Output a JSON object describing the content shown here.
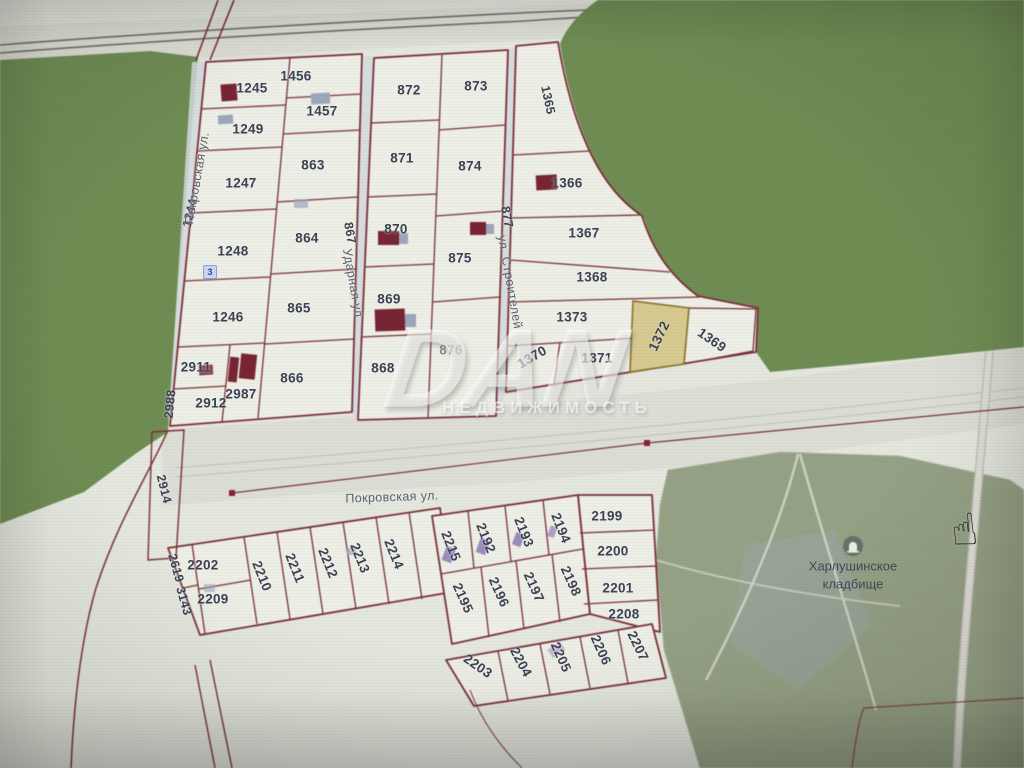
{
  "map": {
    "selected_parcel": "1372",
    "watermark": {
      "line1": "DAN",
      "line2": "НЕДВИЖИМОСТЬ"
    },
    "cemetery": {
      "line1": "Харлушинское",
      "line2": "кладбище"
    },
    "badge": {
      "text": "3"
    },
    "icons": {
      "cursor": "☝",
      "cemetery_icon": "grave-marker"
    },
    "colors": {
      "base": "#e4e7de",
      "roadFill": "#dcded6",
      "parcelFill": "#edefe6",
      "forest": "#6e8d50",
      "cemetery": "#95a184",
      "line": "#7d2f3a",
      "hlFill": "#d9c98e",
      "hlLine": "#8a7228",
      "label": "#3c4254",
      "street": "#59616e",
      "bldRed": "#7b2433",
      "bldGray": "#9ba7bb",
      "bldPurple": "#9c8cc0",
      "marker": "#8d1f2d"
    },
    "labels": [
      {
        "text": "1245",
        "x": 252,
        "y": 88
      },
      {
        "text": "1456",
        "x": 296,
        "y": 76
      },
      {
        "text": "1457",
        "x": 322,
        "y": 111
      },
      {
        "text": "1249",
        "x": 248,
        "y": 129
      },
      {
        "text": "863",
        "x": 313,
        "y": 165
      },
      {
        "text": "1247",
        "x": 241,
        "y": 183
      },
      {
        "text": "1248",
        "x": 233,
        "y": 251
      },
      {
        "text": "864",
        "x": 307,
        "y": 238
      },
      {
        "text": "865",
        "x": 299,
        "y": 308
      },
      {
        "text": "1246",
        "x": 228,
        "y": 317
      },
      {
        "text": "2911",
        "x": 196,
        "y": 367
      },
      {
        "text": "866",
        "x": 292,
        "y": 378
      },
      {
        "text": "2912",
        "x": 211,
        "y": 403
      },
      {
        "text": "2987",
        "x": 241,
        "y": 394
      },
      {
        "text": "872",
        "x": 409,
        "y": 90
      },
      {
        "text": "873",
        "x": 476,
        "y": 86
      },
      {
        "text": "871",
        "x": 402,
        "y": 158
      },
      {
        "text": "874",
        "x": 470,
        "y": 166
      },
      {
        "text": "870",
        "x": 396,
        "y": 229
      },
      {
        "text": "875",
        "x": 460,
        "y": 258
      },
      {
        "text": "869",
        "x": 389,
        "y": 299
      },
      {
        "text": "876",
        "x": 451,
        "y": 350,
        "cls": "dim"
      },
      {
        "text": "868",
        "x": 383,
        "y": 368
      },
      {
        "text": "1366",
        "x": 567,
        "y": 183
      },
      {
        "text": "1367",
        "x": 584,
        "y": 233
      },
      {
        "text": "1368",
        "x": 592,
        "y": 277
      },
      {
        "text": "1373",
        "x": 572,
        "y": 317
      },
      {
        "text": "1371",
        "x": 597,
        "y": 358
      },
      {
        "text": "2202",
        "x": 203,
        "y": 565
      },
      {
        "text": "2209",
        "x": 213,
        "y": 599
      },
      {
        "text": "2199",
        "x": 607,
        "y": 516
      },
      {
        "text": "2200",
        "x": 613,
        "y": 551
      },
      {
        "text": "2201",
        "x": 618,
        "y": 588
      },
      {
        "text": "2208",
        "x": 624,
        "y": 614
      },
      {
        "text": "1244",
        "x": 190,
        "y": 213,
        "rot": -77,
        "cls": "edge"
      },
      {
        "text": "1365",
        "x": 548,
        "y": 100,
        "rot": 78,
        "cls": "edge"
      },
      {
        "text": "867",
        "x": 350,
        "y": 233,
        "rot": 80,
        "cls": "edge"
      },
      {
        "text": "877",
        "x": 507,
        "y": 217,
        "rot": 80,
        "cls": "edge"
      },
      {
        "text": "2988",
        "x": 170,
        "y": 404,
        "rot": -84,
        "cls": "edge"
      },
      {
        "text": "2914",
        "x": 164,
        "y": 489,
        "rot": 76,
        "cls": "edge"
      },
      {
        "text": "2619",
        "x": 176,
        "y": 568,
        "rot": 74,
        "cls": "edge"
      },
      {
        "text": "3143",
        "x": 184,
        "y": 601,
        "rot": 74,
        "cls": "edge"
      },
      {
        "text": "1370",
        "x": 532,
        "y": 357,
        "rot": -30
      },
      {
        "text": "1372",
        "x": 659,
        "y": 336,
        "rot": -64,
        "name": "selected-parcel-label"
      },
      {
        "text": "1369",
        "x": 712,
        "y": 340,
        "rot": 35
      },
      {
        "text": "2210",
        "x": 262,
        "y": 576,
        "rot": 68
      },
      {
        "text": "2211",
        "x": 295,
        "y": 568,
        "rot": 68
      },
      {
        "text": "2212",
        "x": 328,
        "y": 563,
        "rot": 68
      },
      {
        "text": "2213",
        "x": 360,
        "y": 558,
        "rot": 68
      },
      {
        "text": "2214",
        "x": 394,
        "y": 554,
        "rot": 68
      },
      {
        "text": "2215",
        "x": 451,
        "y": 546,
        "rot": 68
      },
      {
        "text": "2192",
        "x": 486,
        "y": 538,
        "rot": 68
      },
      {
        "text": "2193",
        "x": 524,
        "y": 532,
        "rot": 68
      },
      {
        "text": "2194",
        "x": 561,
        "y": 528,
        "rot": 68
      },
      {
        "text": "2195",
        "x": 463,
        "y": 598,
        "rot": 66
      },
      {
        "text": "2196",
        "x": 499,
        "y": 592,
        "rot": 66
      },
      {
        "text": "2197",
        "x": 534,
        "y": 587,
        "rot": 66
      },
      {
        "text": "2198",
        "x": 571,
        "y": 581,
        "rot": 66
      },
      {
        "text": "2203",
        "x": 478,
        "y": 666,
        "rot": 35
      },
      {
        "text": "2204",
        "x": 521,
        "y": 662,
        "rot": 62
      },
      {
        "text": "2205",
        "x": 561,
        "y": 657,
        "rot": 66
      },
      {
        "text": "2206",
        "x": 601,
        "y": 650,
        "rot": 66
      },
      {
        "text": "2207",
        "x": 638,
        "y": 646,
        "rot": 64
      },
      {
        "text": "Покровская ул.",
        "x": 197,
        "y": 178,
        "rot": -80,
        "cls": "street",
        "name": "street-label-pokrovskaya-vertical"
      },
      {
        "text": "Ударная ул",
        "x": 353,
        "y": 283,
        "rot": 80,
        "cls": "street",
        "name": "street-label-udarnaya"
      },
      {
        "text": "ул. Строителей",
        "x": 510,
        "y": 282,
        "rot": 80,
        "cls": "street",
        "name": "street-label-stroiteley"
      },
      {
        "text": "Покровская ул.",
        "x": 392,
        "y": 497,
        "rot": -2,
        "cls": "street",
        "name": "street-label-pokrovskaya-horizontal"
      }
    ]
  }
}
